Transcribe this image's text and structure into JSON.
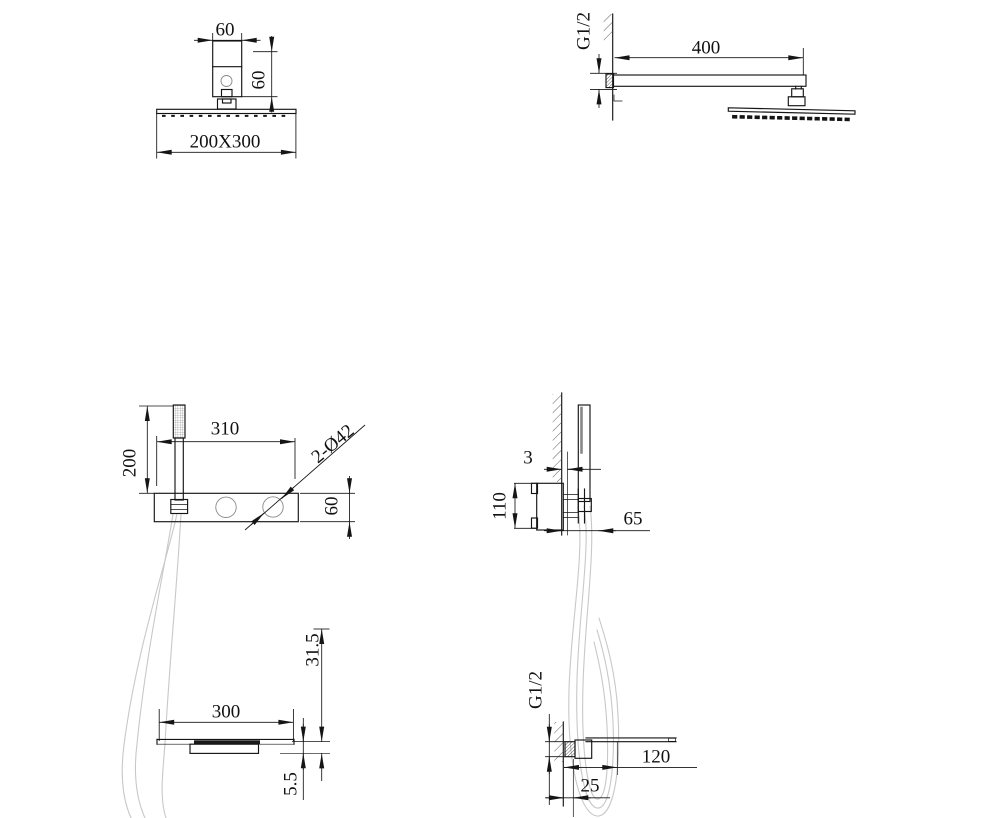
{
  "drawings": {
    "overhead_shower_front": {
      "bracket_width": "60",
      "bracket_height": "60",
      "head_size": "200X300"
    },
    "overhead_shower_side": {
      "thread": "G1/2",
      "arm_length": "400"
    },
    "mixer_front": {
      "hand_shower_height": "200",
      "panel_width": "310",
      "knob_holes": "2-Ø42",
      "panel_height": "60"
    },
    "mixer_side": {
      "wall_thickness": "3",
      "valve_height": "110",
      "projection": "65"
    },
    "spout_front": {
      "width": "300",
      "height": "31.5",
      "plate_thickness": "5.5"
    },
    "spout_side": {
      "thread": "G1/2",
      "length": "120",
      "inset": "25"
    }
  }
}
